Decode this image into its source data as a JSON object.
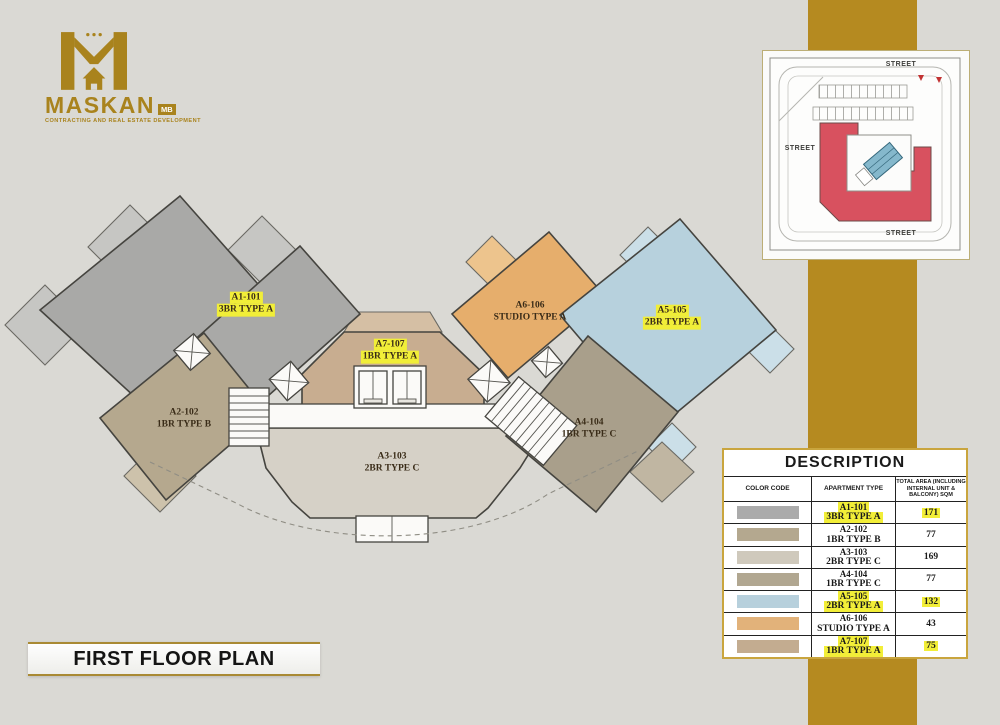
{
  "page": {
    "background": "#dad9d4",
    "accent_gold": "#b58a20"
  },
  "logo": {
    "brand": "MASKAN",
    "suffix": "MB",
    "tagline": "CONTRACTING AND REAL ESTATE DEVELOPMENT"
  },
  "title_bar": {
    "text": "FIRST FLOOR PLAN"
  },
  "site_map": {
    "street_top": "STREET",
    "street_left": "STREET",
    "street_bottom": "STREET",
    "building_color": "#d8515f"
  },
  "floor_plan": {
    "units": [
      {
        "id": "A1-101",
        "type": "3BR TYPE A",
        "highlighted": true,
        "color": "#a9a9a7",
        "balcony_color": "#c6c6c3"
      },
      {
        "id": "A2-102",
        "type": "1BR TYPE B",
        "highlighted": false,
        "color": "#b5a88e",
        "balcony_color": "#cdc2ab"
      },
      {
        "id": "A3-103",
        "type": "2BR TYPE C",
        "highlighted": false,
        "color": "#d6d1c7",
        "balcony_color": "#e2ded4"
      },
      {
        "id": "A4-104",
        "type": "1BR TYPE C",
        "highlighted": false,
        "color": "#a99f8b",
        "balcony_color": "#c0b6a2"
      },
      {
        "id": "A5-105",
        "type": "2BR TYPE A",
        "highlighted": true,
        "color": "#b7d1dd",
        "balcony_color": "#cbdfe8"
      },
      {
        "id": "A6-106",
        "type": "STUDIO TYPE A",
        "highlighted": false,
        "color": "#e6ae6c",
        "balcony_color": "#edc48d"
      },
      {
        "id": "A7-107",
        "type": "1BR TYPE A",
        "highlighted": true,
        "color": "#c8ad90",
        "balcony_color": "#d5bfa4"
      }
    ]
  },
  "description_table": {
    "title": "DESCRIPTION",
    "columns": [
      "COLOR CODE",
      "APARTMENT TYPE",
      "TOTAL AREA (INCLUDING INTERNAL UNIT & BALCONY) SQM"
    ],
    "rows": [
      {
        "code": "A1-101",
        "type": "3BR TYPE A",
        "area": "171",
        "highlighted": true,
        "color": "#ababab"
      },
      {
        "code": "A2-102",
        "type": "1BR TYPE B",
        "area": "77",
        "highlighted": false,
        "color": "#b4a88f"
      },
      {
        "code": "A3-103",
        "type": "2BR TYPE C",
        "area": "169",
        "highlighted": false,
        "color": "#cfc9bc"
      },
      {
        "code": "A4-104",
        "type": "1BR TYPE C",
        "area": "77",
        "highlighted": false,
        "color": "#b1a791"
      },
      {
        "code": "A5-105",
        "type": "2BR TYPE A",
        "area": "132",
        "highlighted": true,
        "color": "#b7d0dc"
      },
      {
        "code": "A6-106",
        "type": "STUDIO TYPE A",
        "area": "43",
        "highlighted": false,
        "color": "#e2b27a"
      },
      {
        "code": "A7-107",
        "type": "1BR TYPE A",
        "area": "75",
        "highlighted": true,
        "color": "#c3ac90"
      }
    ]
  }
}
